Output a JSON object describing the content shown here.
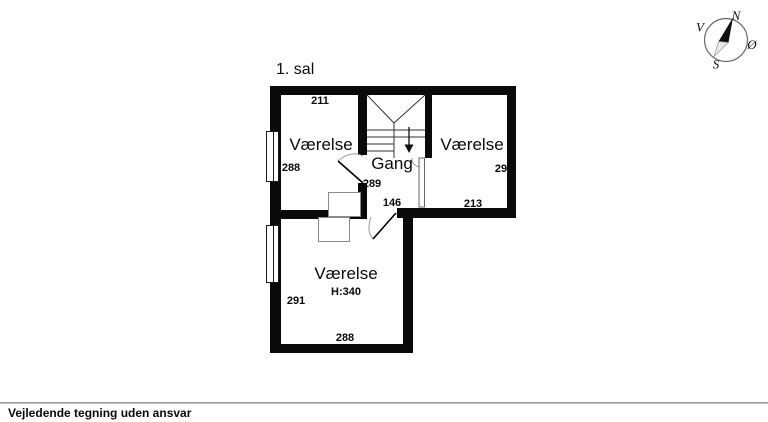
{
  "title": "1. sal",
  "rooms": {
    "top_left": {
      "label": "Værelse",
      "dim_top": "211",
      "dim_left": "288"
    },
    "hall": {
      "label": "Gang",
      "dim": "289",
      "door_dim": "146"
    },
    "right": {
      "label": "Værelse",
      "dim_right": "291",
      "dim_bottom": "213"
    },
    "bottom": {
      "label": "Værelse",
      "ceiling_height": "H:340",
      "dim_left": "291",
      "dim_bottom": "288"
    }
  },
  "compass": {
    "north": "N",
    "east": "Ø",
    "south": "S",
    "west": "V"
  },
  "footer": {
    "disclaimer": "Vejledende tegning uden ansvar"
  },
  "colors": {
    "wall": "#0a0a0a",
    "thin_line": "#333333",
    "arc": "#999999"
  }
}
